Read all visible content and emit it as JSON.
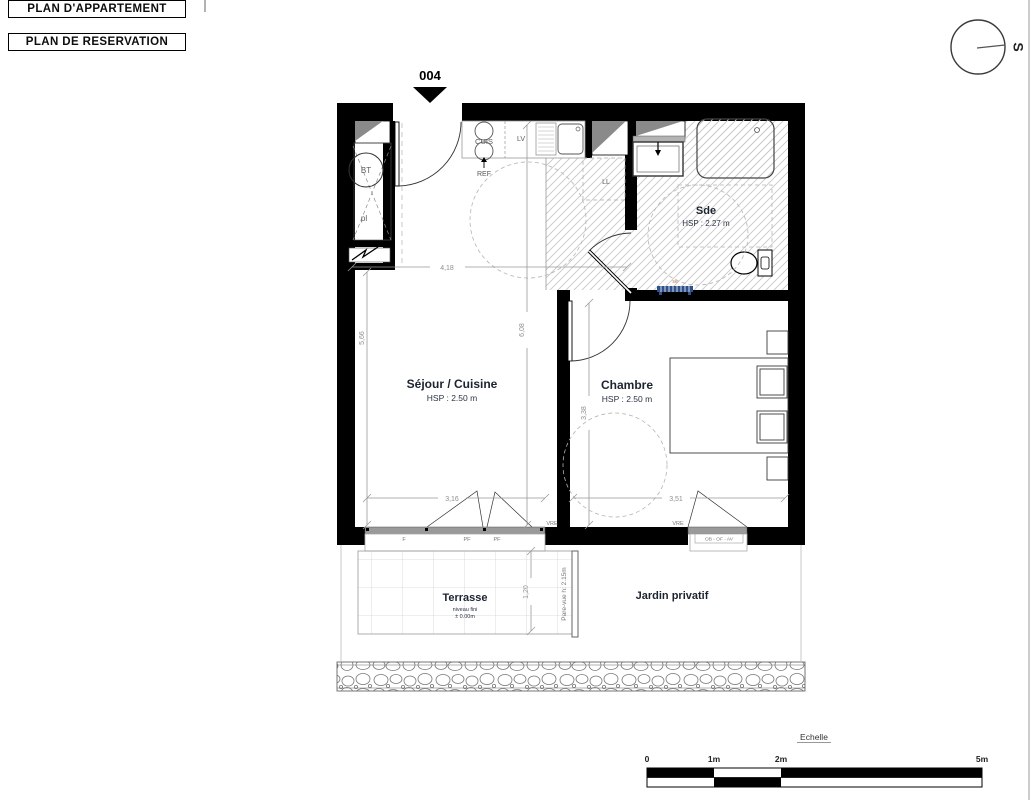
{
  "titles": {
    "plan_appartement": "PLAN D'APPARTEMENT",
    "plan_reservation": "PLAN DE RESERVATION"
  },
  "compass": {
    "south": "S"
  },
  "lot": {
    "number": "004"
  },
  "rooms": {
    "sde": {
      "name": "Sde",
      "hsp": "HSP : 2.27 m"
    },
    "sejour": {
      "name": "Séjour / Cuisine",
      "hsp": "HSP : 2.50 m"
    },
    "chambre": {
      "name": "Chambre",
      "hsp": "HSP : 2.50 m"
    },
    "terrasse": {
      "name": "Terrasse",
      "note_line1": "niveau fini",
      "note_line2": "± 0.00m"
    },
    "jardin": {
      "name": "Jardin privatif"
    }
  },
  "fixtures": {
    "bt": "BT",
    "pl": "pl",
    "cuis": "CUIS",
    "ref": "REF",
    "lv": "LV",
    "ll": "LL",
    "seche": "sè"
  },
  "windows": {
    "f": "F",
    "pf_left": "PF",
    "pf_right": "PF",
    "vre_sejour": "VRE",
    "vre_chambre": "VRE",
    "ob_of_av": "OB - OF - AV",
    "pare_vue": "Pare-vue h: 2.15m"
  },
  "dimensions": {
    "top_width": "4,18",
    "left_height": "5,66",
    "mid_height": "6,08",
    "sejour_width": "3,16",
    "chambre_width": "3,51",
    "chambre_height": "3,38",
    "terrasse_depth": "1,20"
  },
  "scale_bar": {
    "title": "Echelle",
    "tick_0": "0",
    "tick_1": "1m",
    "tick_2": "2m",
    "tick_5": "5m"
  },
  "colors": {
    "wall": "#000000",
    "hatch_line": "#c8c8c8",
    "dim_text": "#8f8f8f",
    "room_label": "#1c2430",
    "radiator_blue": "#30508c",
    "shaft_grey": "#8a8a8a",
    "seche_label": "#c07a3a"
  }
}
